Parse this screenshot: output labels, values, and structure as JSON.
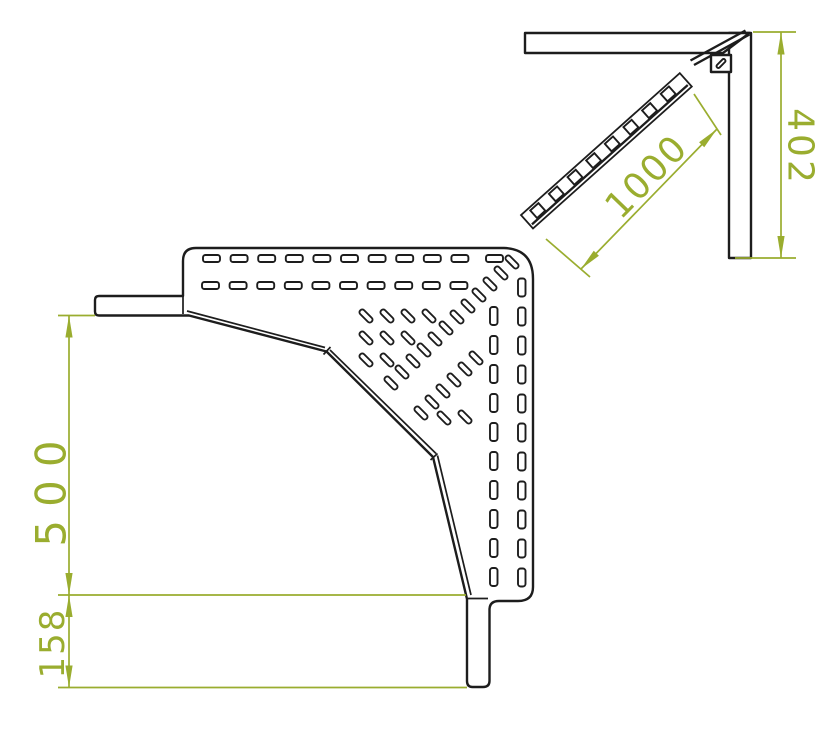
{
  "drawing": {
    "plan_view": {
      "height_label": "500",
      "tab_label": "158"
    },
    "side_view": {
      "length_label": "1000",
      "height_label": "402"
    }
  },
  "colors": {
    "dimension": "#9aad2f",
    "line": "#1d1d1d",
    "background": "#ffffff"
  },
  "geometry": {
    "slot_sizes": {
      "horizontal": {
        "w": 17,
        "h": 7,
        "rx": 2.4
      },
      "vertical": {
        "w": 7.5,
        "h": 18,
        "rx": 2.6
      },
      "diagonal": {
        "w": 16,
        "h": 5.5,
        "rx": 2.6,
        "angle": 45
      }
    },
    "top_slot_rows": [
      {
        "y": 255,
        "x_start": 203,
        "pitch": 27.6,
        "count": 10
      },
      {
        "y": 255,
        "x_start": 486,
        "pitch": 27.6,
        "count": 1
      },
      {
        "y": 282,
        "x_start": 202,
        "pitch": 27.6,
        "count": 10
      }
    ],
    "right_slot_cols": [
      {
        "x": 490,
        "y_start": 307,
        "pitch": 29,
        "count": 10
      },
      {
        "x": 518,
        "y_start": 278.5,
        "pitch": 29,
        "count": 11
      }
    ],
    "diag_slots": [
      [
        366,
        316
      ],
      [
        387,
        316
      ],
      [
        408,
        316
      ],
      [
        429,
        316
      ],
      [
        366,
        338
      ],
      [
        387,
        338
      ],
      [
        408,
        338
      ],
      [
        366,
        360
      ],
      [
        387,
        360
      ],
      [
        391,
        383
      ],
      [
        402,
        372
      ],
      [
        413,
        361
      ],
      [
        424,
        350
      ],
      [
        435,
        339
      ],
      [
        446,
        328
      ],
      [
        457,
        317
      ],
      [
        468,
        306
      ],
      [
        479,
        295
      ],
      [
        490,
        284
      ],
      [
        501,
        273
      ],
      [
        512,
        262
      ],
      [
        421,
        413
      ],
      [
        432,
        402
      ],
      [
        443,
        391
      ],
      [
        454,
        380
      ],
      [
        465,
        369
      ],
      [
        476,
        358
      ],
      [
        444,
        418
      ],
      [
        465,
        417
      ]
    ],
    "ladder_rungs": {
      "count": 8,
      "pitch": 25,
      "x0": 10,
      "y": -15.3,
      "w": 11,
      "h": 10.2
    }
  }
}
